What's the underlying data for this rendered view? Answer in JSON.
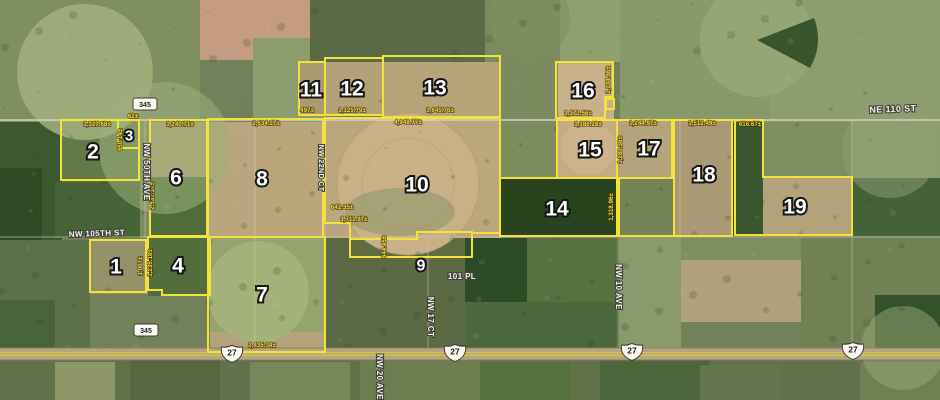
{
  "map": {
    "colors": {
      "parcel_line": "#f2e23b",
      "area_label": "#f4d93c",
      "number_fill": "#ffffff",
      "number_outline": "#161616",
      "road_label": "#f4f3ea",
      "road_label_halo": "#41413a",
      "highway_fill": "#b5a67f",
      "highway_stripe": "#d9c544",
      "shield_bg": "#fbfaf2",
      "shield_border": "#3c3c38",
      "shield_text": "#1f1f1f"
    },
    "parcels": [
      {
        "number": "1",
        "number_pos": [
          116,
          266
        ],
        "points": [
          [
            90,
            240
          ],
          [
            146,
            240
          ],
          [
            146,
            292
          ],
          [
            90,
            292
          ]
        ],
        "labels": [
          {
            "text": "1,007±",
            "pos": [
              142,
              266
            ],
            "rotate": -90
          }
        ]
      },
      {
        "number": "2",
        "number_pos": [
          93,
          151
        ],
        "points": [
          [
            61,
            120
          ],
          [
            118,
            120
          ],
          [
            118,
            148
          ],
          [
            139,
            148
          ],
          [
            139,
            180
          ],
          [
            61,
            180
          ]
        ],
        "labels": [
          {
            "text": "1,327.68±",
            "pos": [
              97,
              126
            ],
            "rotate": 0
          }
        ]
      },
      {
        "number": "3",
        "number_pos": [
          129,
          135
        ],
        "points": [
          [
            118,
            120
          ],
          [
            139,
            120
          ],
          [
            139,
            148
          ],
          [
            118,
            148
          ]
        ],
        "labels": [
          {
            "text": "62±",
            "pos": [
              133,
              118
            ],
            "rotate": 0
          },
          {
            "text": "650.14±",
            "pos": [
              122,
              140
            ],
            "rotate": -90
          }
        ]
      },
      {
        "number": "4",
        "number_pos": [
          178,
          265
        ],
        "points": [
          [
            148,
            237
          ],
          [
            210,
            237
          ],
          [
            210,
            295
          ],
          [
            162,
            295
          ],
          [
            162,
            290
          ],
          [
            148,
            290
          ]
        ],
        "labels": [
          {
            "text": "1,235.18±",
            "pos": [
              152,
              263
            ],
            "rotate": -90
          }
        ]
      },
      {
        "number": "6",
        "number_pos": [
          176,
          177
        ],
        "points": [
          [
            150,
            120
          ],
          [
            207,
            120
          ],
          [
            207,
            236
          ],
          [
            150,
            236
          ]
        ],
        "labels": [
          {
            "text": "1,240.71±",
            "pos": [
              180,
              126
            ],
            "rotate": 0
          },
          {
            "text": "2,537.37±",
            "pos": [
              154,
              196
            ],
            "rotate": -90
          }
        ]
      },
      {
        "number": "7",
        "number_pos": [
          262,
          294
        ],
        "points": [
          [
            208,
            237
          ],
          [
            325,
            237
          ],
          [
            325,
            352
          ],
          [
            208,
            352
          ]
        ],
        "labels": [
          {
            "text": "2,435.34±",
            "pos": [
              262,
              347
            ],
            "rotate": 0
          }
        ]
      },
      {
        "number": "8",
        "number_pos": [
          262,
          178
        ],
        "points": [
          [
            208,
            119
          ],
          [
            323,
            119
          ],
          [
            323,
            237
          ],
          [
            208,
            237
          ]
        ],
        "labels": [
          {
            "text": "2,634.27±",
            "pos": [
              266,
              125
            ],
            "rotate": 0
          }
        ]
      },
      {
        "number": "9",
        "number_pos": [
          421,
          265
        ],
        "points": [
          [
            350,
            239
          ],
          [
            417,
            239
          ],
          [
            417,
            232
          ],
          [
            472,
            232
          ],
          [
            472,
            257
          ],
          [
            350,
            257
          ]
        ],
        "labels": [
          {
            "text": "644.45±",
            "pos": [
              386,
              247
            ],
            "rotate": -90
          }
        ]
      },
      {
        "number": "10",
        "number_pos": [
          417,
          184
        ],
        "points": [
          [
            325,
            118
          ],
          [
            500,
            118
          ],
          [
            500,
            233
          ],
          [
            472,
            233
          ],
          [
            472,
            232
          ],
          [
            417,
            232
          ],
          [
            417,
            239
          ],
          [
            350,
            239
          ],
          [
            350,
            223
          ],
          [
            325,
            223
          ]
        ],
        "labels": [
          {
            "text": "4,948.77±",
            "pos": [
              408,
              124
            ],
            "rotate": 0
          },
          {
            "text": "1,711.97±",
            "pos": [
              354,
              221
            ],
            "rotate": 0
          },
          {
            "text": "642.35±",
            "pos": [
              342,
              209
            ],
            "rotate": 0
          }
        ]
      },
      {
        "number": "11",
        "number_pos": [
          311,
          89
        ],
        "points": [
          [
            299,
            62
          ],
          [
            325,
            62
          ],
          [
            325,
            115
          ],
          [
            299,
            115
          ]
        ],
        "labels": [
          {
            "text": "497±",
            "pos": [
              307,
              112
            ],
            "rotate": 0
          }
        ]
      },
      {
        "number": "12",
        "number_pos": [
          352,
          88
        ],
        "points": [
          [
            325,
            58
          ],
          [
            383,
            58
          ],
          [
            383,
            115
          ],
          [
            325,
            115
          ]
        ],
        "labels": [
          {
            "text": "1,125.79±",
            "pos": [
              352,
              112
            ],
            "rotate": 0
          }
        ]
      },
      {
        "number": "13",
        "number_pos": [
          435,
          87
        ],
        "points": [
          [
            383,
            56
          ],
          [
            500,
            56
          ],
          [
            500,
            117
          ],
          [
            383,
            117
          ]
        ],
        "labels": [
          {
            "text": "1,645.76±",
            "pos": [
              440,
              112
            ],
            "rotate": 0
          }
        ]
      },
      {
        "number": "14",
        "number_pos": [
          557,
          208
        ],
        "points": [
          [
            500,
            178
          ],
          [
            619,
            178
          ],
          [
            619,
            236
          ],
          [
            500,
            236
          ]
        ],
        "labels": [
          {
            "text": "1,318.96±",
            "pos": [
              613,
              207
            ],
            "rotate": -90
          }
        ]
      },
      {
        "number": "15",
        "number_pos": [
          590,
          149
        ],
        "points": [
          [
            557,
            120
          ],
          [
            617,
            120
          ],
          [
            617,
            178
          ],
          [
            557,
            178
          ]
        ],
        "labels": [
          {
            "text": "1,186.28±",
            "pos": [
              588,
              126
            ],
            "rotate": 0
          }
        ]
      },
      {
        "number": "16",
        "number_pos": [
          583,
          90
        ],
        "points": [
          [
            556,
            62
          ],
          [
            613,
            62
          ],
          [
            613,
            97
          ],
          [
            605,
            97
          ],
          [
            605,
            118
          ],
          [
            556,
            118
          ]
        ],
        "labels": [
          {
            "text": "1,034.66±",
            "pos": [
              610,
              80
            ],
            "rotate": -90
          },
          {
            "text": "1,172.56±",
            "pos": [
              578,
              115
            ],
            "rotate": 0
          }
        ]
      },
      {
        "number": "17",
        "number_pos": [
          649,
          148
        ],
        "points": [
          [
            617,
            120
          ],
          [
            672,
            120
          ],
          [
            672,
            178
          ],
          [
            617,
            178
          ]
        ],
        "labels": [
          {
            "text": "1,244.97±",
            "pos": [
              643,
              125
            ],
            "rotate": 0
          },
          {
            "text": "1,280.36±",
            "pos": [
              622,
              150
            ],
            "rotate": -90
          }
        ]
      },
      {
        "number": "18",
        "number_pos": [
          704,
          174
        ],
        "points": [
          [
            674,
            120
          ],
          [
            732,
            120
          ],
          [
            732,
            236
          ],
          [
            674,
            236
          ]
        ],
        "labels": [
          {
            "text": "1,512.49±",
            "pos": [
              702,
              125
            ],
            "rotate": 0
          }
        ]
      },
      {
        "number": "19",
        "number_pos": [
          795,
          206
        ],
        "points": [
          [
            735,
            120
          ],
          [
            763,
            120
          ],
          [
            763,
            177
          ],
          [
            852,
            177
          ],
          [
            852,
            235
          ],
          [
            735,
            235
          ]
        ],
        "labels": [
          {
            "text": "616.67±",
            "pos": [
              750,
              126
            ],
            "rotate": 0
          }
        ]
      },
      {
        "number": "",
        "number_pos": [
          0,
          0
        ],
        "points": [
          [
            617,
            178
          ],
          [
            674,
            178
          ],
          [
            674,
            236
          ],
          [
            617,
            236
          ]
        ],
        "labels": []
      },
      {
        "number": "",
        "number_pos": [
          0,
          0
        ],
        "points": [
          [
            606,
            99
          ],
          [
            614,
            99
          ],
          [
            614,
            109
          ],
          [
            606,
            109
          ]
        ],
        "labels": []
      }
    ],
    "roads": {
      "labels": [
        {
          "text": "NE 110 ST",
          "pos": [
            893,
            112
          ],
          "rotate": -2,
          "size": 9
        },
        {
          "text": "NW 105TH ST",
          "pos": [
            97,
            236
          ],
          "rotate": -2,
          "size": 8
        },
        {
          "text": "NW 50TH AVE",
          "pos": [
            144,
            172
          ],
          "rotate": 90,
          "size": 8
        },
        {
          "text": "NW 22ND CT",
          "pos": [
            319,
            168
          ],
          "rotate": 90,
          "size": 7
        },
        {
          "text": "NW 17 CT",
          "pos": [
            428,
            317
          ],
          "rotate": 90,
          "size": 8
        },
        {
          "text": "NW 20 AVE",
          "pos": [
            377,
            377
          ],
          "rotate": 90,
          "size": 8
        },
        {
          "text": "NW 10 AVE",
          "pos": [
            616,
            287
          ],
          "rotate": 90,
          "size": 8
        },
        {
          "text": "101 PL",
          "pos": [
            462,
            279
          ],
          "rotate": 0,
          "size": 8
        }
      ],
      "shields": [
        {
          "type": "state",
          "text": "345",
          "pos": [
            145,
            104
          ]
        },
        {
          "type": "state",
          "text": "345",
          "pos": [
            146,
            330
          ]
        },
        {
          "type": "us",
          "text": "27",
          "pos": [
            232,
            354
          ]
        },
        {
          "type": "us",
          "text": "27",
          "pos": [
            455,
            353
          ]
        },
        {
          "type": "us",
          "text": "27",
          "pos": [
            632,
            352
          ]
        },
        {
          "type": "us",
          "text": "27",
          "pos": [
            853,
            351
          ]
        }
      ]
    }
  }
}
